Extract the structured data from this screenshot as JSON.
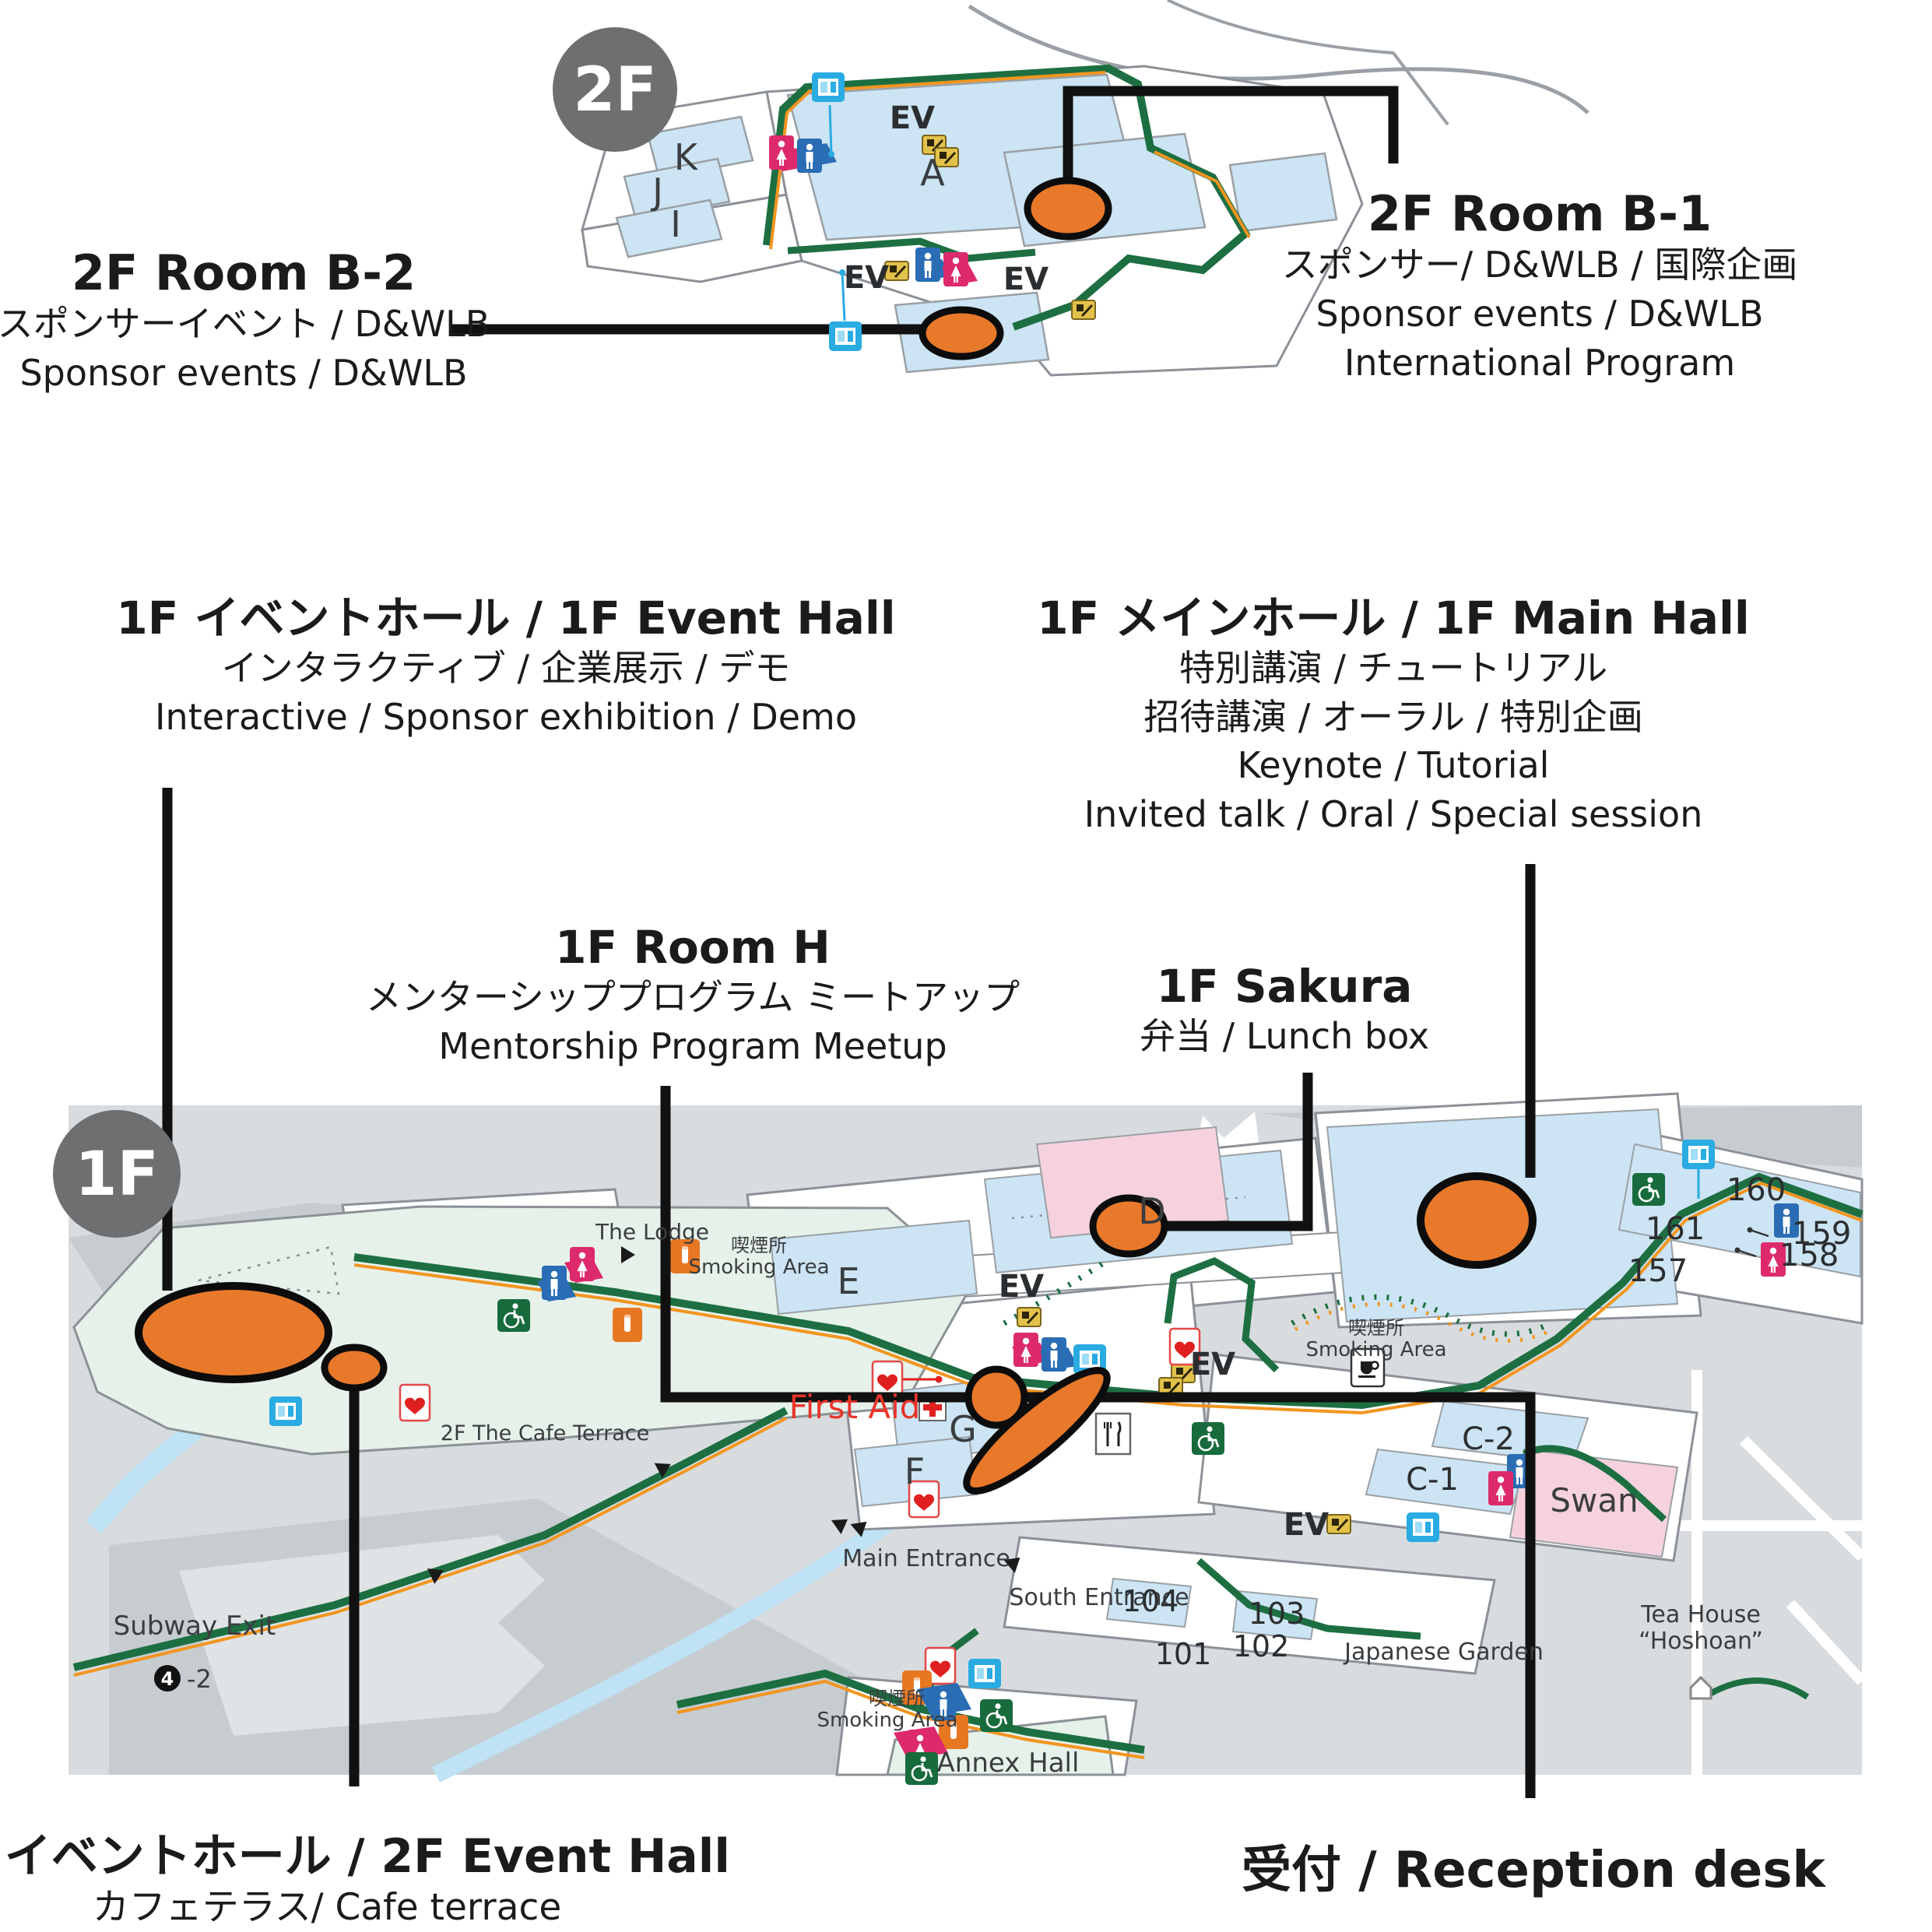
{
  "floor2": {
    "badge": "2F",
    "map": {
      "a": "A",
      "k": "K",
      "j": "J",
      "i": "I",
      "ev": "EV"
    },
    "labels": {
      "b2": {
        "title": "2F Room B-2",
        "jp": "スポンサーイベント / D&WLB",
        "en": "Sponsor events / D&WLB"
      },
      "b1": {
        "title": "2F Room B-1",
        "jp": "スポンサー/ D&WLB / 国際企画",
        "en1": "Sponsor events / D&WLB",
        "en2": "International Program"
      }
    }
  },
  "floor1": {
    "badge": "1F",
    "labels": {
      "event_hall": {
        "title": "1F イベントホール / 1F  Event Hall",
        "jp": "インタラクティブ / 企業展示 / デモ",
        "en": "Interactive / Sponsor exhibition / Demo"
      },
      "main_hall": {
        "title": "1F メインホール / 1F Main Hall",
        "jp1": "特別講演 / チュートリアル",
        "jp2": "招待講演 / オーラル / 特別企画",
        "en1": "Keynote / Tutorial",
        "en2": "Invited talk / Oral / Special session"
      },
      "room_h": {
        "title": "1F Room H",
        "jp": "メンターシッププログラム ミートアップ",
        "en": "Mentorship Program Meetup"
      },
      "sakura": {
        "title": "1F Sakura",
        "sub": "弁当 / Lunch box"
      },
      "event_hall_2f": {
        "title": "2F イベントホール / 2F  Event Hall",
        "sub": "カフェテラス/ Cafe terrace"
      },
      "reception": {
        "text": "受付 / Reception desk"
      }
    },
    "map": {
      "lodge": "The Lodge",
      "smoking_jp": "喫煙所",
      "smoking_en": "Smoking Area",
      "e": "E",
      "d": "D",
      "g": "G",
      "f": "F",
      "ev": "EV",
      "first_aid": "First Aid",
      "cafe_terrace": "2F The Cafe Terrace",
      "main_entrance": "Main Entrance",
      "south_entrance": "South Entrance",
      "r104": "104",
      "r103": "103",
      "r102": "102",
      "r101": "101",
      "c2": "C-2",
      "c1": "C-1",
      "swan": "Swan",
      "r157": "157",
      "r158": "158",
      "r159": "159",
      "r160": "160",
      "r161": "161",
      "garden": "Japanese Garden",
      "tea1": "Tea House",
      "tea2": "“Hoshoan”",
      "subway": "Subway Exit",
      "subway_num": "4",
      "subway_suffix": "-2",
      "annex": "Annex Hall"
    }
  },
  "icons": {
    "female-restroom": "🚺",
    "male-restroom": "🚹",
    "wheelchair": "♿",
    "smoking": "🚬",
    "aed": "♥",
    "first-aid": "✚",
    "vending": "🥤",
    "coffee": "☕",
    "restaurant": "🍴",
    "escalator": "escalator",
    "tea-house": "⌂",
    "subway": "④",
    "route-arrow": "▲"
  },
  "colors": {
    "marker_orange": "#E8792A",
    "route_green": "#1D6F42",
    "route_orange": "#F2951F",
    "room_blue": "#CCE4F3",
    "room_pink": "#F6D2DE",
    "hall_mint": "#E6F1EA",
    "band_gray": "#D8DCDF",
    "badge_gray": "#6E6F71",
    "restroom_f": "#DD2A6C",
    "restroom_m": "#2A6DB5",
    "vending_blue": "#2AABE2",
    "wheelchair_green": "#176B3C",
    "smoking_orange": "#E87722",
    "first_aid_red": "#E8342A",
    "connector_black": "#111111"
  }
}
